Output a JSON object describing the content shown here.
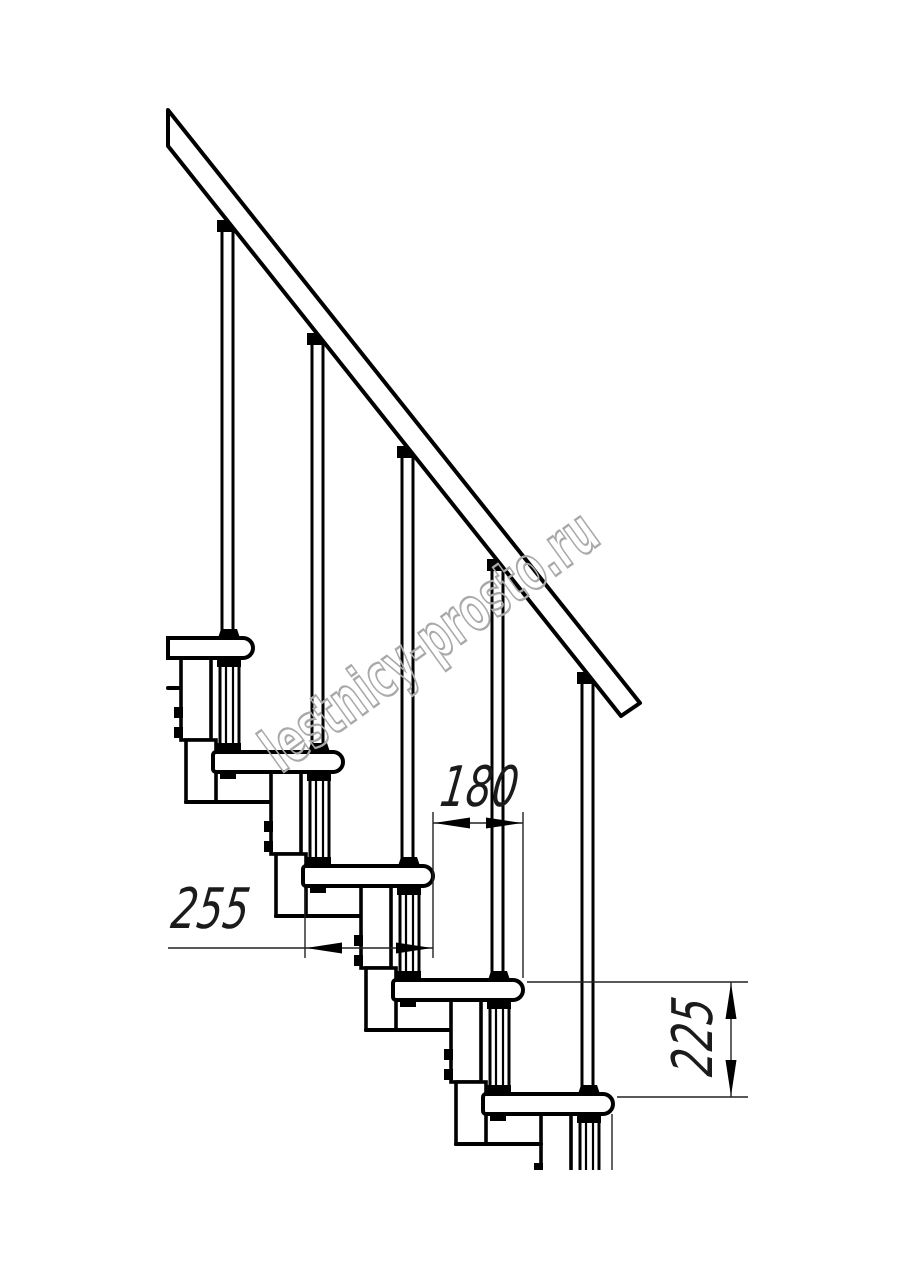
{
  "page": {
    "background": "#ffffff",
    "line_color": "#000000",
    "kind": "modular staircase side-view technical drawing"
  },
  "drawing": {
    "dimensions": {
      "step_run": {
        "label": "180"
      },
      "tread_depth": {
        "label": "255"
      },
      "step_rise": {
        "label": "225"
      }
    },
    "watermark": {
      "text": "lestnicy-prosto.ru",
      "color": "#a9a9a9"
    }
  }
}
